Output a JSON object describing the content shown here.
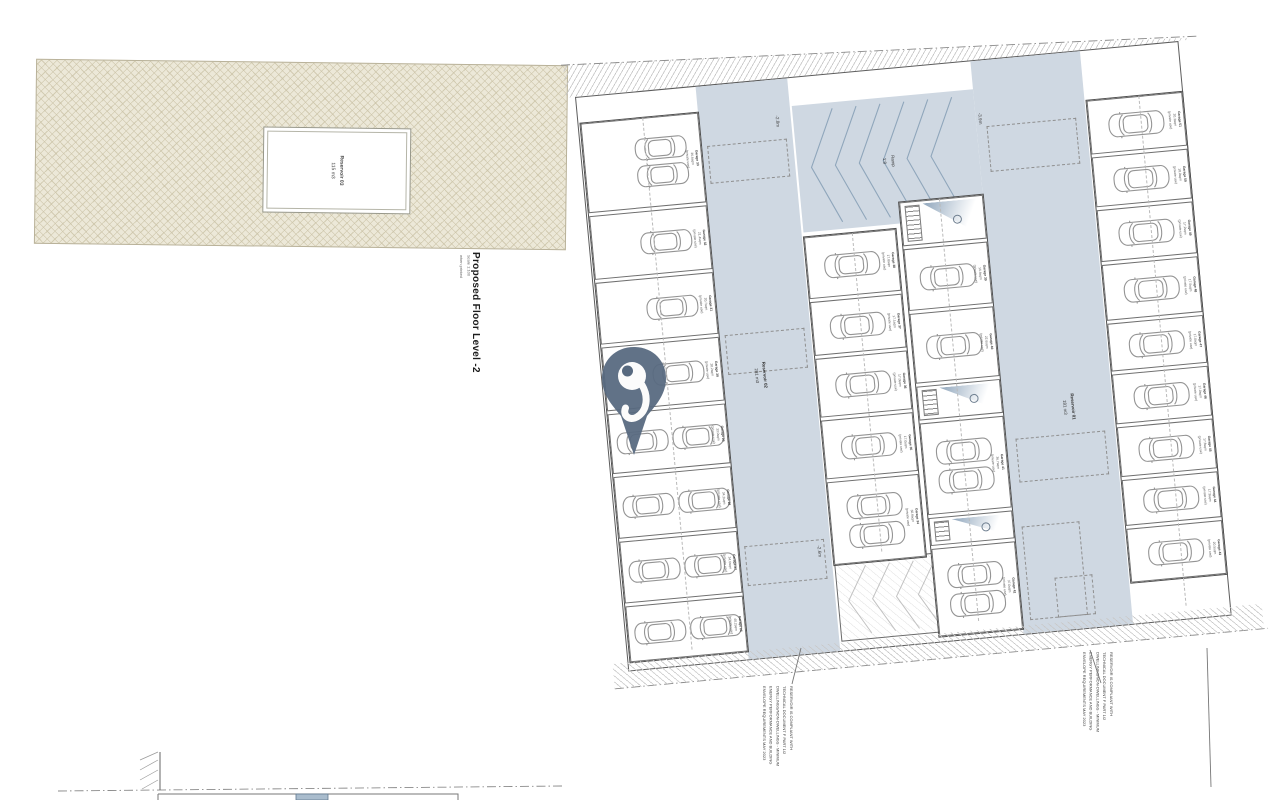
{
  "drawing": {
    "title": "Proposed Floor Level -2",
    "scale": "Scale 1:100",
    "scale_note": "when printed",
    "ramp": {
      "label": "Ramp",
      "slope": "1:8"
    },
    "levels": {
      "top_left": "-2.8m",
      "top_right": "-3.9m",
      "bottom_left": "-2.6m"
    },
    "reservoirs": {
      "r01": {
        "name": "Reservoir 01",
        "volume": "181 m3"
      },
      "r02": {
        "name": "Reservoir 02",
        "volume": "281 m3"
      },
      "r03": {
        "name": "Reservoir 03",
        "volume": "115 m3"
      }
    },
    "garage_use": "(private use)",
    "columns": [
      {
        "name": "left",
        "bays": [
          {
            "id": "Garage 33",
            "area": "36.6sqm",
            "cars": 2,
            "layout": "stackR",
            "h": 88
          },
          {
            "id": "Garage 32",
            "area": "21.4sqm",
            "cars": 1,
            "layout": "right1",
            "h": 62
          },
          {
            "id": "Garage 31",
            "area": "20.7sqm",
            "cars": 1,
            "layout": "right1",
            "h": 60
          },
          {
            "id": "Garage 30",
            "area": "20.2sqm",
            "cars": 1,
            "layout": "right1",
            "h": 62
          },
          {
            "id": "Garage 29",
            "area": "33.0sqm",
            "cars": 2,
            "layout": "tandem",
            "h": 58
          },
          {
            "id": "Garage 28",
            "area": "34.2sqm",
            "cars": 2,
            "layout": "tandem",
            "h": 60
          },
          {
            "id": "Garage 27",
            "area": "34.6sqm",
            "cars": 2,
            "layout": "tandem",
            "h": 60
          },
          {
            "id": "Garage 26",
            "area": "40.2sqm",
            "cars": 2,
            "layout": "tandem",
            "h": 54
          }
        ]
      },
      {
        "name": "center-left",
        "bays": [
          {
            "id": "Garage 38",
            "area": "17.8sqm",
            "cars": 1,
            "layout": "single",
            "h": 60
          },
          {
            "id": "Garage 37",
            "area": "17.1sqm",
            "cars": 1,
            "layout": "single",
            "h": 52
          },
          {
            "id": "Garage 36",
            "area": "17.0sqm",
            "cars": 1,
            "layout": "single",
            "h": 57
          },
          {
            "id": "Garage 35",
            "area": "17.0sqm",
            "cars": 1,
            "layout": "single",
            "h": 57
          },
          {
            "id": "Garage 34",
            "area": "30.8sqm",
            "cars": 2,
            "layout": "stack",
            "h": 81
          }
        ]
      },
      {
        "name": "center-right",
        "bays": [
          {
            "type": "core",
            "h": 42
          },
          {
            "id": "Garage 39",
            "area": "16.6sqm",
            "cars": 1,
            "layout": "single",
            "h": 60
          },
          {
            "id": "Garage 40",
            "area": "22.6sqm",
            "cars": 1,
            "layout": "single",
            "h": 68
          },
          {
            "type": "core",
            "h": 32
          },
          {
            "id": "Garage 41",
            "area": "36.7sqm",
            "cars": 2,
            "layout": "stack",
            "h": 90
          },
          {
            "type": "core",
            "h": 26
          },
          {
            "id": "Garage 42",
            "area": "37.0sqm",
            "cars": 2,
            "layout": "stack",
            "h": 86
          }
        ]
      },
      {
        "name": "right",
        "bays": [
          {
            "id": "Garage 51",
            "area": "20.3sqm",
            "cars": 1,
            "layout": "single",
            "h": 52
          },
          {
            "id": "Garage 50",
            "area": "18.0sqm",
            "cars": 1,
            "layout": "single",
            "h": 48
          },
          {
            "id": "Garage 49",
            "area": "17.2sqm",
            "cars": 1,
            "layout": "single",
            "h": 50
          },
          {
            "id": "Garage 48",
            "area": "17.5sqm",
            "cars": 1,
            "layout": "single",
            "h": 54
          },
          {
            "id": "Garage 47",
            "area": "17.0sqm",
            "cars": 1,
            "layout": "single",
            "h": 46
          },
          {
            "id": "Garage 46",
            "area": "17.0sqm",
            "cars": 1,
            "layout": "single",
            "h": 48
          },
          {
            "id": "Garage 45",
            "area": "17.8sqm",
            "cars": 1,
            "layout": "single",
            "h": 48
          },
          {
            "id": "Garage 44",
            "area": "17.9sqm",
            "cars": 1,
            "layout": "single",
            "h": 44
          },
          {
            "id": "Garage 43",
            "area": "20.5sqm",
            "cars": 1,
            "layout": "single",
            "h": 52
          }
        ]
      }
    ],
    "compliance_note": {
      "lines": [
        "RESERVOIR IS COMPLIANT WITH",
        "TECHNICAL DOCUMENT F PART 1/2",
        "DWELLINGS/NON-DWELLINGS - MINIMUM",
        "ENERGY PERFORMANCE AND BUILDING",
        "ENVELOPE REQUIREMENTS MAY 2023"
      ]
    }
  },
  "colors": {
    "aisle_blue": "#cfd8e2",
    "chevron_blue": "#8fa6bb",
    "pin_blue": "#57697f",
    "parcel_beige": "#ece8d8",
    "parcel_line": "#cac2a6"
  }
}
